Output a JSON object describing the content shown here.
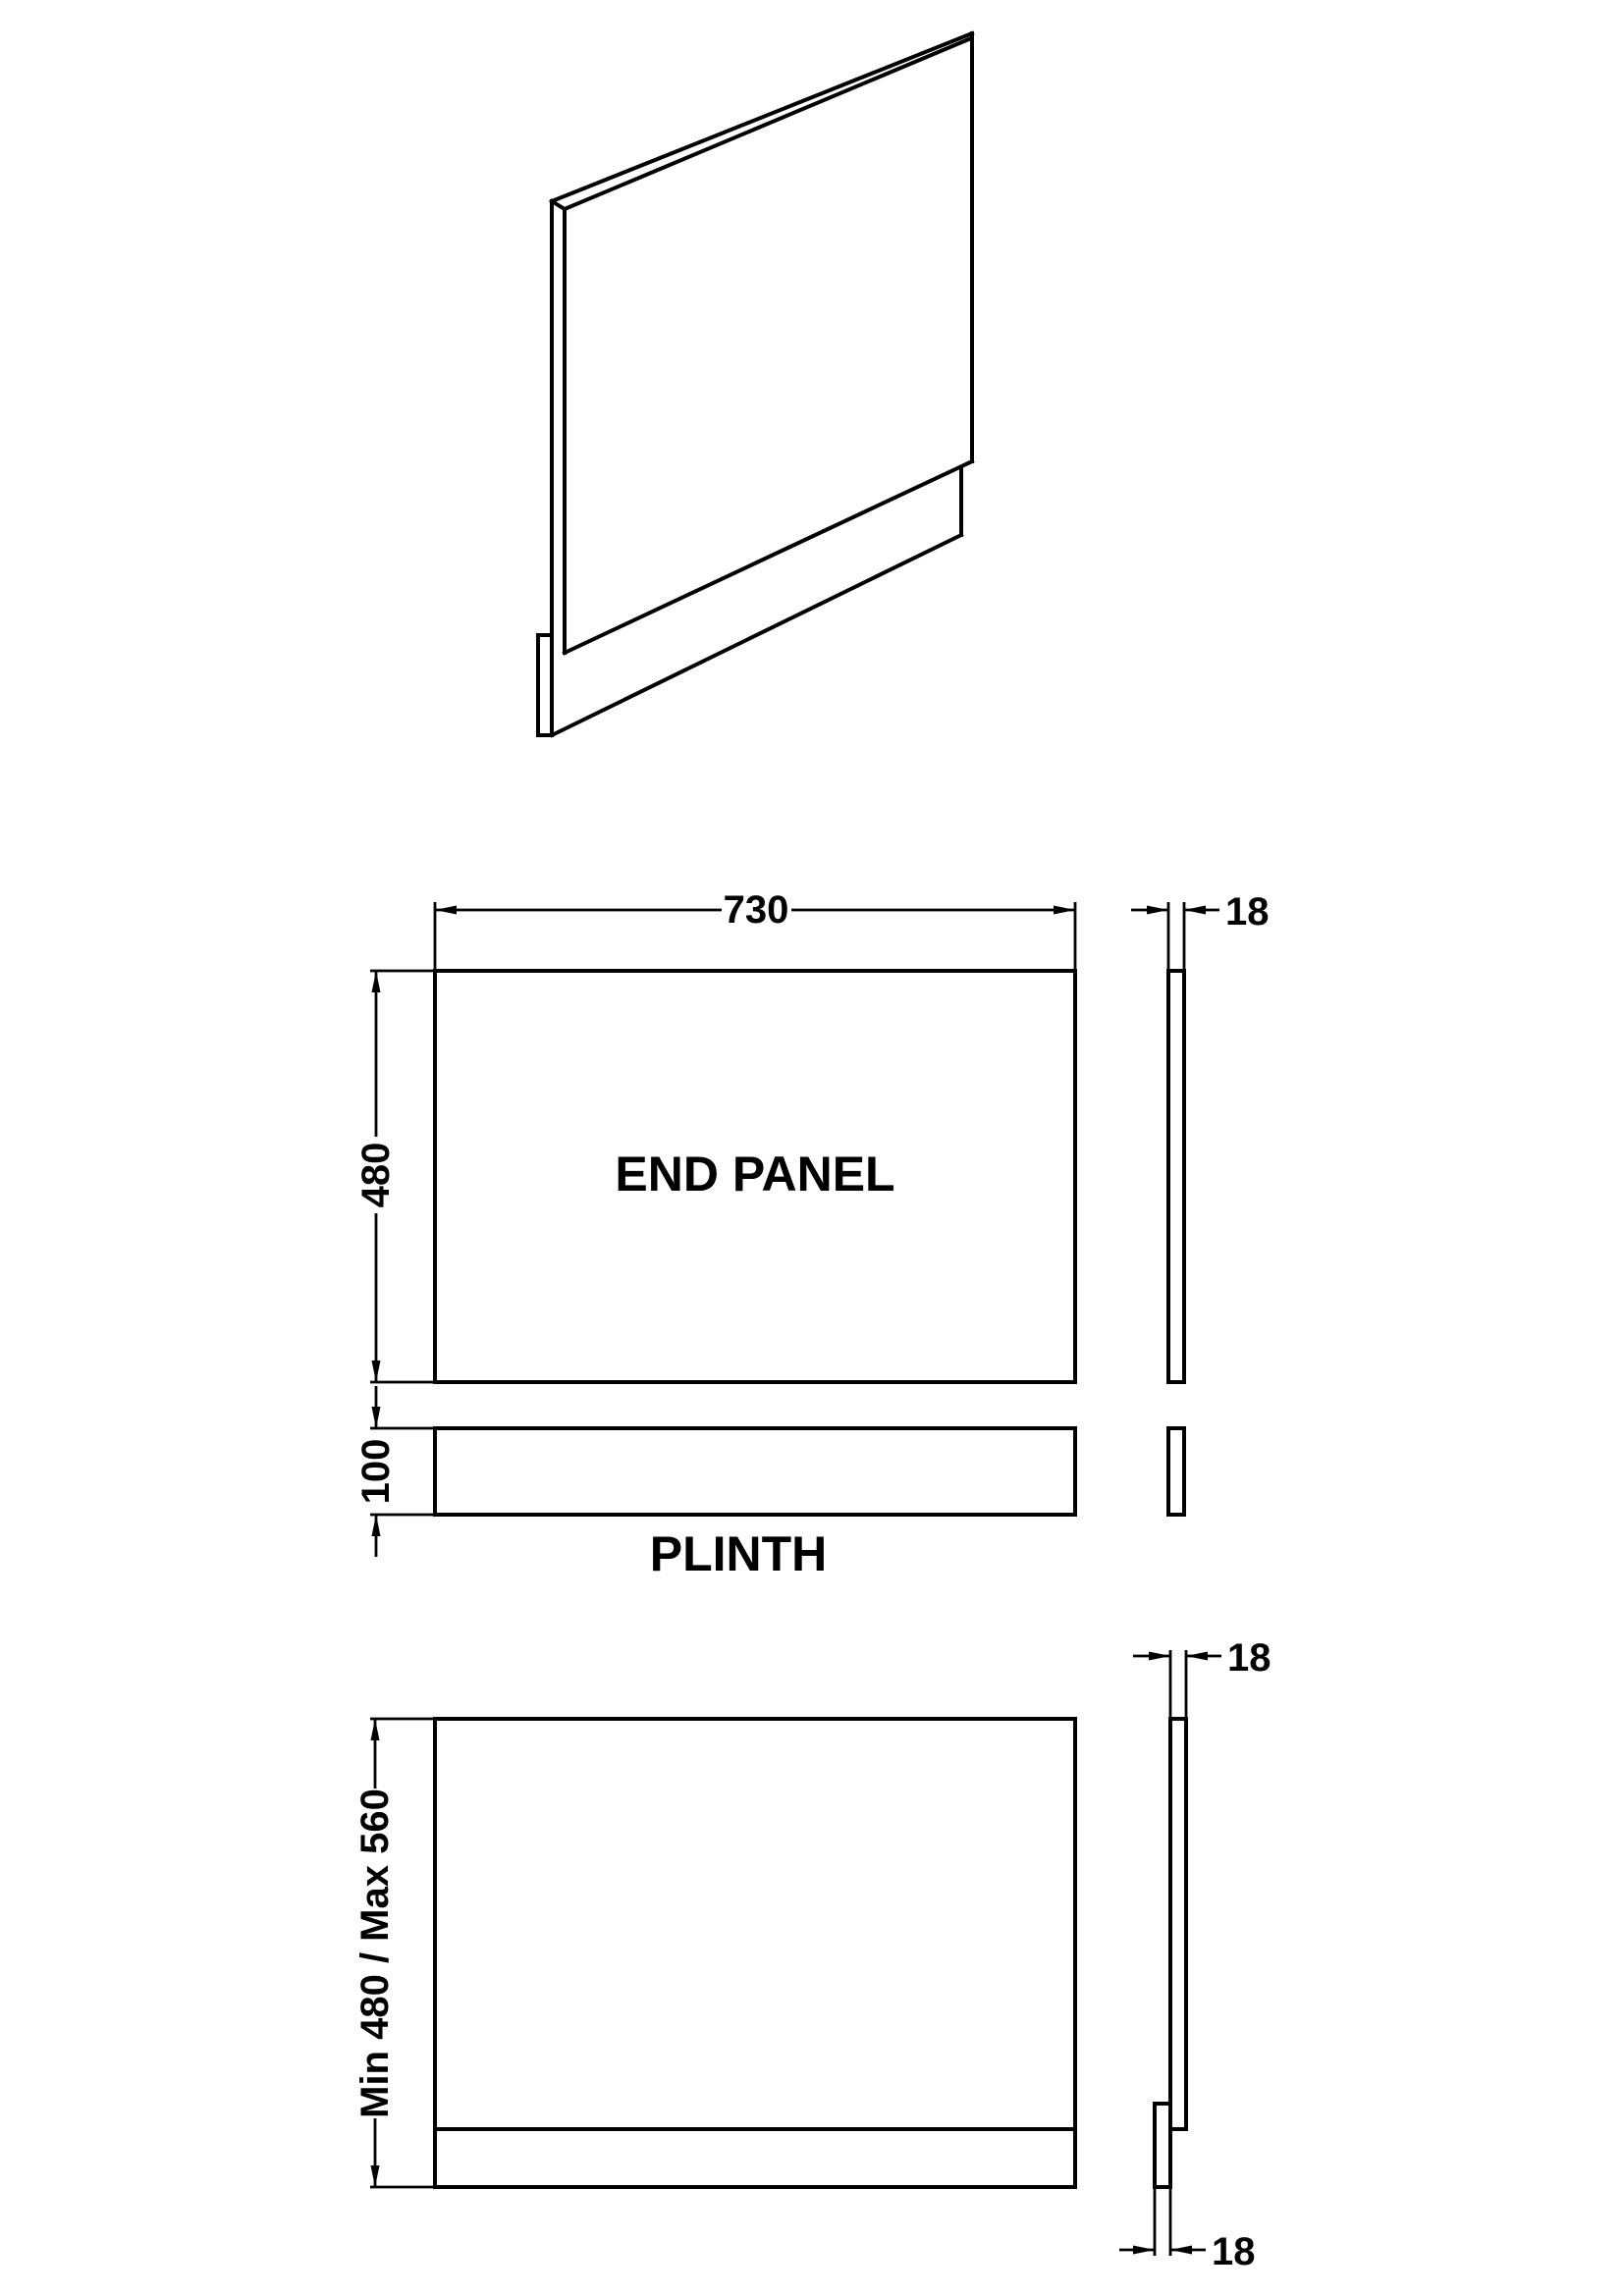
{
  "drawing": {
    "end_panel_label": "END PANEL",
    "plinth_label": "PLINTH",
    "dims": {
      "panel_width": "730",
      "panel_height": "480",
      "panel_thickness": "18",
      "plinth_height": "100",
      "overall_height": "Min 480 / Max 560"
    }
  },
  "colors": {
    "line": "#000000",
    "background": "#ffffff"
  }
}
